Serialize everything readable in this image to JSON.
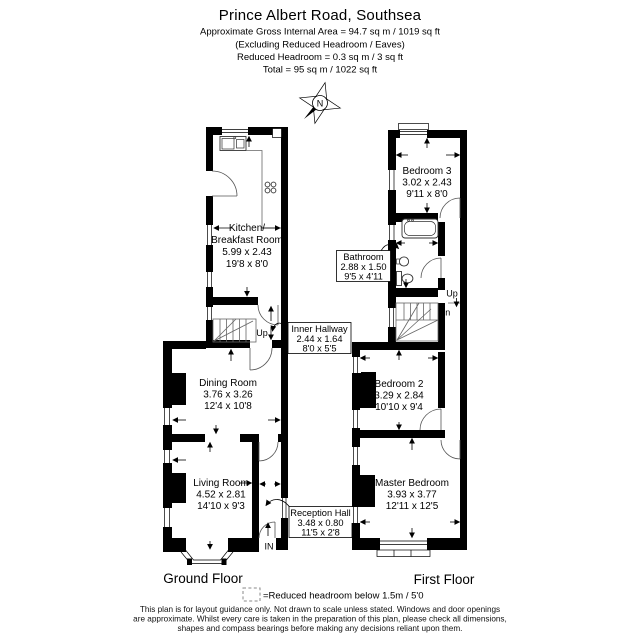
{
  "header": {
    "title": "Prince Albert Road, Southsea",
    "area_line": "Approximate Gross Internal Area = 94.7 sq m / 1019 sq ft",
    "excluding_line": "(Excluding Reduced Headroom / Eaves)",
    "reduced_line": "Reduced Headroom = 0.3 sq m / 3 sq ft",
    "total_line": "Total = 95 sq m / 1022 sq ft"
  },
  "compass": {
    "north": "N"
  },
  "ground_floor": {
    "label": "Ground Floor",
    "kitchen": {
      "line1": "Kitchen/",
      "line2": "Breakfast Room",
      "metric": "5.99 x 2.43",
      "imperial": "19'8 x 8'0"
    },
    "inner_hallway": {
      "name": "Inner Hallway",
      "metric": "2.44 x 1.64",
      "imperial": "8'0 x 5'5"
    },
    "dining_room": {
      "name": "Dining Room",
      "metric": "3.76 x 3.26",
      "imperial": "12'4 x 10'8"
    },
    "living_room": {
      "name": "Living Room",
      "metric": "4.52 x 2.81",
      "imperial": "14'10 x 9'3"
    },
    "reception_hall": {
      "name": "Reception Hall",
      "metric": "3.48 x 0.80",
      "imperial": "11'5 x 2'8"
    },
    "up": "Up",
    "entrance": "IN"
  },
  "first_floor": {
    "label": "First Floor",
    "bedroom3": {
      "name": "Bedroom 3",
      "metric": "3.02 x 2.43",
      "imperial": "9'11 x 8'0"
    },
    "bathroom": {
      "name": "Bathroom",
      "metric": "2.88 x 1.50",
      "imperial": "9'5 x 4'11"
    },
    "bedroom2": {
      "name": "Bedroom 2",
      "metric": "3.29 x 2.84",
      "imperial": "10'10 x 9'4"
    },
    "master_bedroom": {
      "name": "Master Bedroom",
      "metric": "3.93 x 3.77",
      "imperial": "12'11 x 12'5"
    },
    "up": "Up",
    "down": "Dn"
  },
  "legend": {
    "reduced_headroom": "=Reduced headroom below 1.5m / 5'0"
  },
  "disclaimer": {
    "line1": "This plan is for layout guidance only. Not drawn to scale unless stated. Windows and door openings",
    "line2": "are approximate. Whilst every care is taken in the preparation of this plan, please check all dimensions,",
    "line3": "shapes and compass bearings before making any decisions reliant upon them."
  }
}
